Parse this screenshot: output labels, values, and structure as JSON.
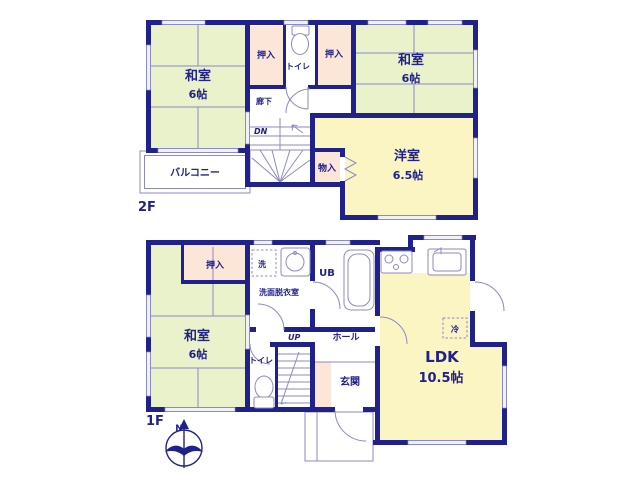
{
  "plan": {
    "f2": {
      "floor_label": "2F",
      "washitsu_left": {
        "name": "和室",
        "size": "6帖"
      },
      "oshiire_a": "押入",
      "toilet": "トイレ",
      "oshiire_b": "押入",
      "washitsu_right": {
        "name": "和室",
        "size": "6帖"
      },
      "hallway": "廊下",
      "stairs": "DN",
      "storage": "物入",
      "yoshitsu": {
        "name": "洋室",
        "size": "6.5帖"
      },
      "balcony": "バルコニー"
    },
    "f1": {
      "floor_label": "1F",
      "oshiire": "押入",
      "washitsu": {
        "name": "和室",
        "size": "6帖"
      },
      "laundry": "洗",
      "washroom": "洗面脱衣室",
      "unit_bath": "UB",
      "hall": "ホール",
      "stairs": "UP",
      "toilet": "トイレ",
      "entrance": "玄関",
      "ldk": {
        "name": "LDK",
        "size": "10.5帖"
      },
      "fridge": "冷"
    },
    "compass": {
      "north": "N"
    },
    "colors": {
      "wall": "#21218c",
      "tatami_room": "#eaf2cc",
      "western_room": "#faf5c3",
      "closet": "#fbe6d8",
      "thin_line": "#8b8bc4",
      "window": "#f1f1fa",
      "background": "#ffffff"
    }
  }
}
